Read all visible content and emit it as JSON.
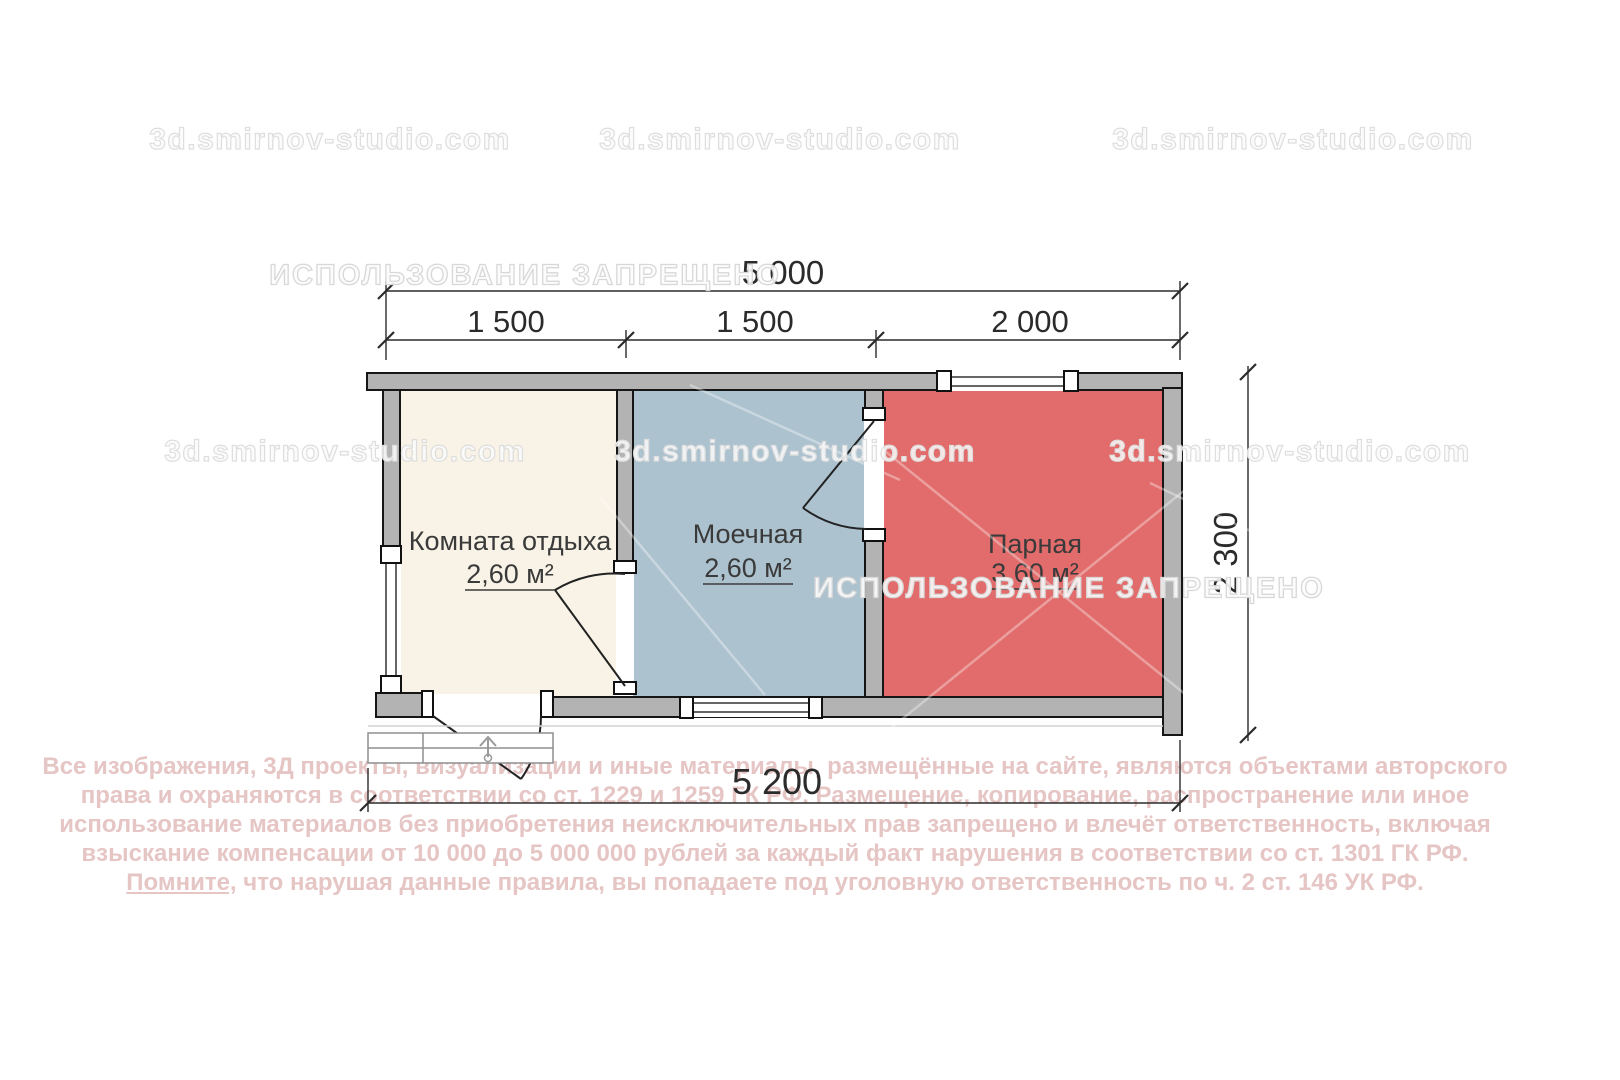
{
  "watermarks": {
    "site": "3d.smirnov-studio.com",
    "ban": "ИСПОЛЬЗОВАНИЕ ЗАПРЕЩЕНО"
  },
  "plan": {
    "wall_color": "#b3b3b3",
    "rooms": [
      {
        "name": "Комната отдыха",
        "area": "2,60 м²",
        "fill": "#f8f3e6"
      },
      {
        "name": "Моечная",
        "area": "2,60 м²",
        "fill": "#adc2cf"
      },
      {
        "name": "Парная",
        "area": "3,60 м²",
        "fill": "#e16c6b"
      }
    ]
  },
  "dimensions": {
    "top_total": "5 000",
    "top_segments": [
      "1 500",
      "1 500",
      "2 000"
    ],
    "right_height": "2 300",
    "bottom_total": "5 200"
  },
  "copyright": {
    "line1": "Все изображения, 3Д проекты, визуализации и иные материалы, размещённые на сайте, являются объектами авторского",
    "line2": "права и охраняются в соответствии со ст. 1229 и 1259 ГК РФ. Размещение, копирование, распространение или иное",
    "line3": "использование материалов без приобретения неисключительных прав запрещено и влечёт ответственность, включая",
    "line4": "взыскание компенсации от 10 000 до 5 000 000 рублей за каждый факт нарушения в соответствии со ст. 1301 ГК РФ.",
    "line5_underlined": "Помните,",
    "line5_rest": " что нарушая данные правила, вы попадаете под уголовную ответственность по ч. 2 ст. 146 УК РФ."
  }
}
